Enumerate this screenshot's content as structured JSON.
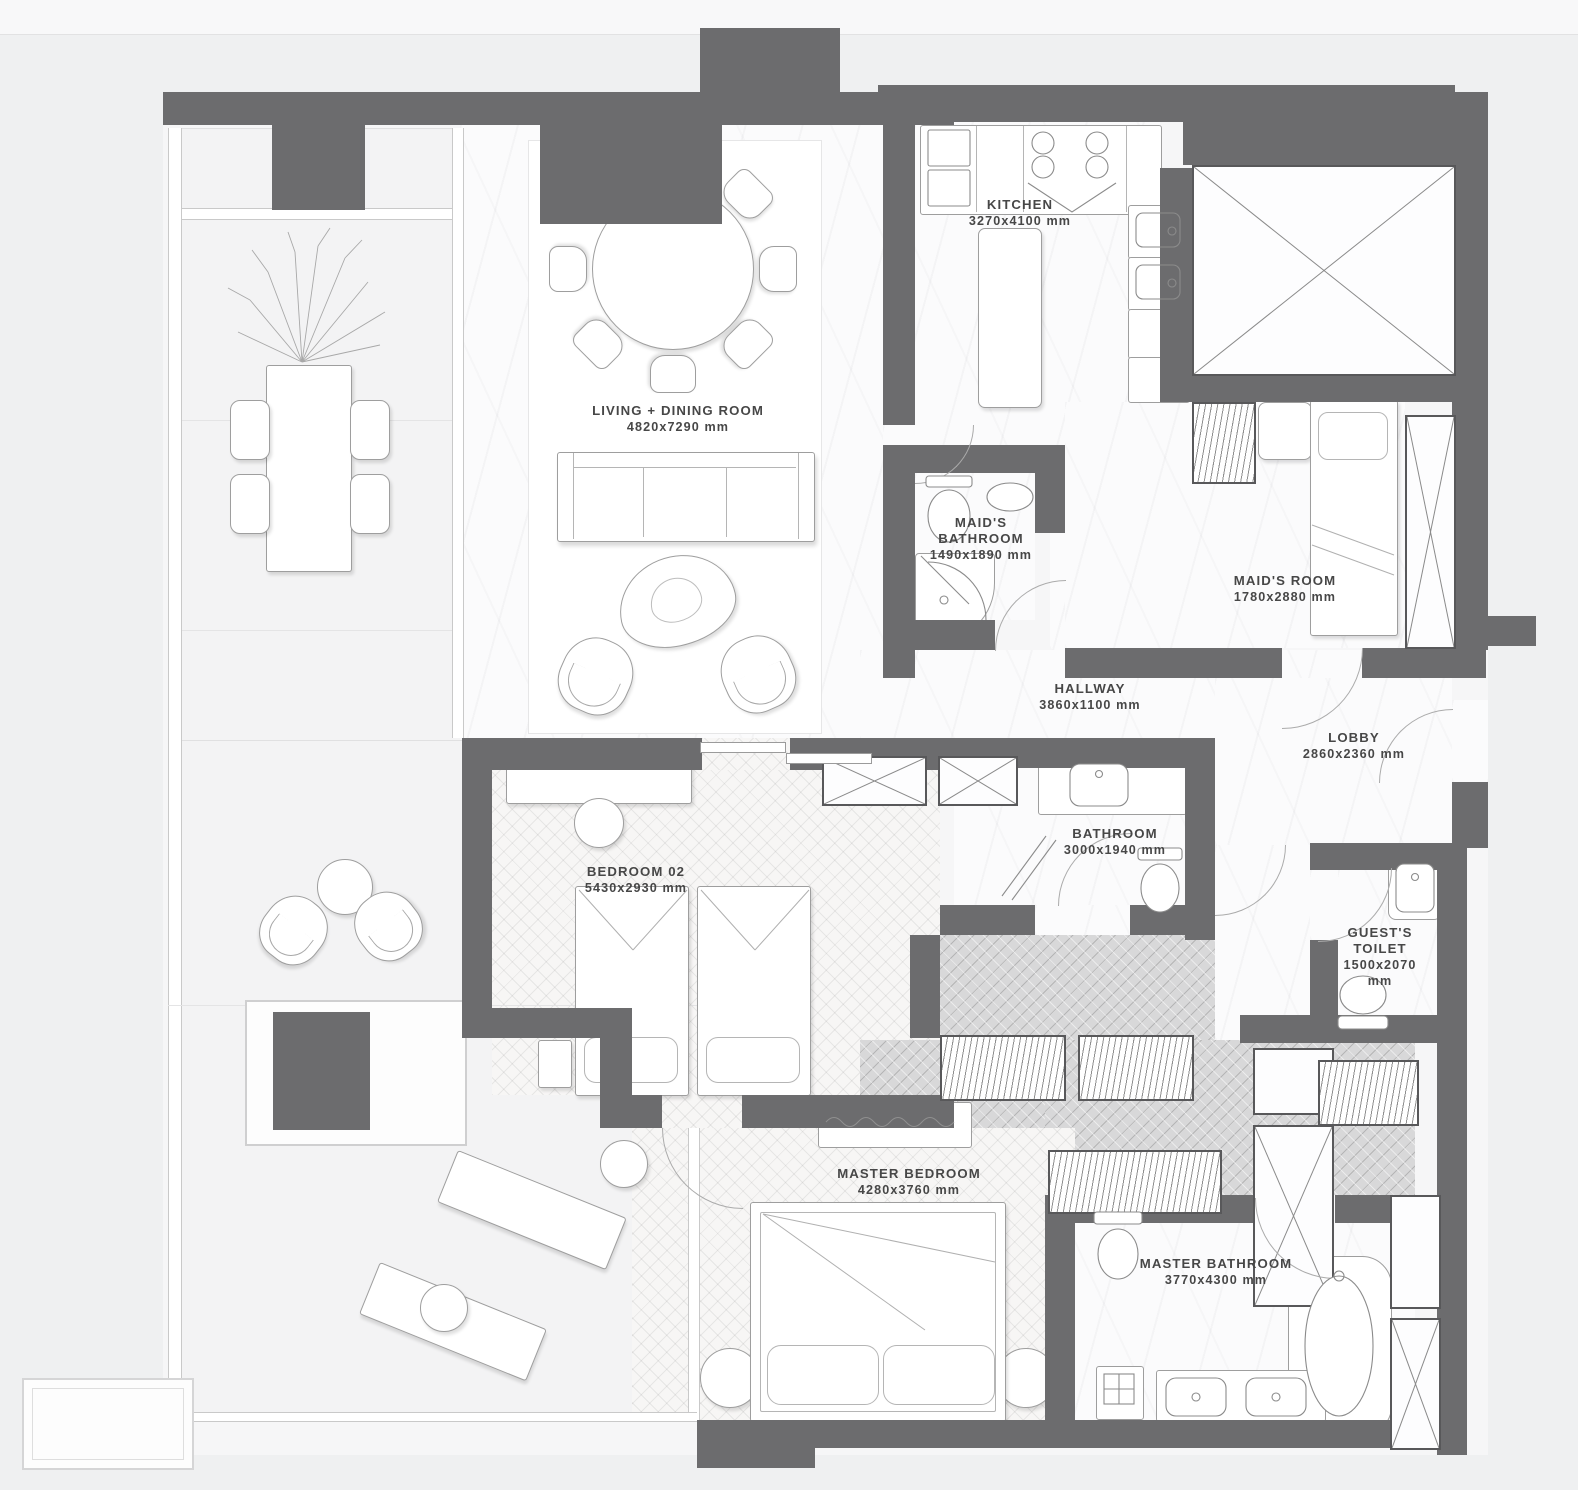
{
  "plan_title": "apartment-floor-plan",
  "colors": {
    "wall": "#6c6c6e",
    "background": "#eff0f1",
    "top_strip": "#f8f8f9",
    "floor_marble": "#fbfbfc",
    "floor_terrace": "#f3f3f4",
    "floor_wood": "#f7f6f5",
    "floor_dressing": "#d8d8d9",
    "label_text": "#474747",
    "window_frame": "#c9c9c9"
  },
  "rooms": {
    "living": {
      "name": "LIVING + DINING ROOM",
      "dims": "4820x7290 mm"
    },
    "kitchen": {
      "name": "KITCHEN",
      "dims": "3270x4100 mm"
    },
    "maids_bathroom": {
      "name": "MAID'S BATHROOM",
      "dims": "1490x1890 mm"
    },
    "maids_room": {
      "name": "MAID'S ROOM",
      "dims": "1780x2880 mm"
    },
    "hallway": {
      "name": "HALLWAY",
      "dims": "3860x1100 mm"
    },
    "lobby": {
      "name": "LOBBY",
      "dims": "2860x2360 mm"
    },
    "bathroom": {
      "name": "BATHROOM",
      "dims": "3000x1940 mm"
    },
    "bedroom02": {
      "name": "BEDROOM 02",
      "dims": "5430x2930 mm"
    },
    "guests_toilet": {
      "name": "GUEST'S TOILET",
      "dims": "1500x2070 mm"
    },
    "master_bedroom": {
      "name": "MASTER BEDROOM",
      "dims": "4280x3760 mm"
    },
    "master_bathroom": {
      "name": "MASTER BATHROOM",
      "dims": "3770x4300 mm"
    }
  }
}
